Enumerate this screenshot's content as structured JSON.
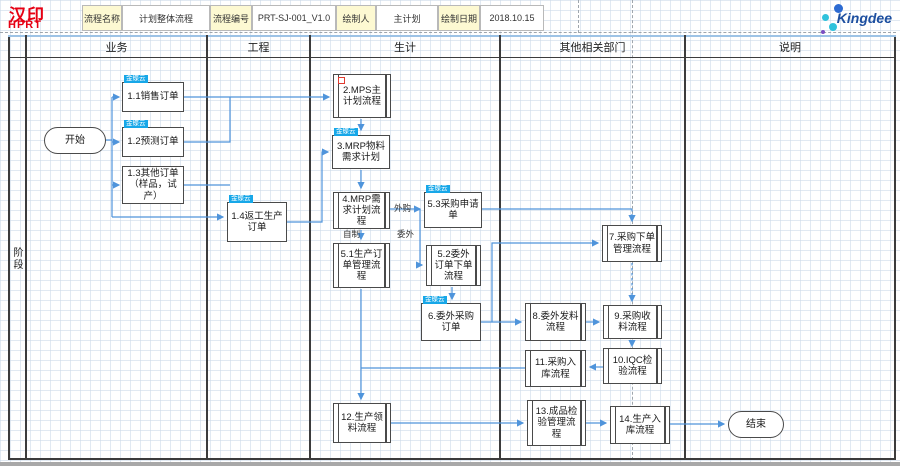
{
  "header": {
    "logo": {
      "line1": "汉印",
      "line2": "HPRT"
    },
    "fields": [
      {
        "label": "流程名称",
        "value": "计划整体流程"
      },
      {
        "label": "流程编号",
        "value": "PRT-SJ-001_V1.0"
      },
      {
        "label": "绘制人",
        "value": "主计划"
      },
      {
        "label": "绘制日期",
        "value": "2018.10.15"
      }
    ],
    "brand": "Kingdee"
  },
  "sidebar": {
    "phase": "阶段"
  },
  "lanes": [
    {
      "label": "业务"
    },
    {
      "label": "工程"
    },
    {
      "label": "生计"
    },
    {
      "label": "其他相关部门"
    },
    {
      "label": "说明"
    }
  ],
  "ui": {
    "badge_label": "金蝶云",
    "accent": "#4f94db",
    "badge_color": "#17a7e8",
    "border_color": "#4a4a4a",
    "logo_red": "#e60013",
    "brand_blue": "#1d4fa0"
  },
  "edges": {
    "outsourced_purchase": "外购",
    "self_made": "自制",
    "outsourced": "委外"
  },
  "nodes": {
    "start": {
      "label": "开始"
    },
    "n1_1": {
      "label": "1.1销售订单"
    },
    "n1_2": {
      "label": "1.2预测订单"
    },
    "n1_3": {
      "label": "1.3其他订单（样品，试产）"
    },
    "n1_4": {
      "label": "1.4返工生产订单"
    },
    "n2": {
      "label": "2.MPS主计划流程"
    },
    "n3": {
      "label": "3.MRP物料需求计划"
    },
    "n4": {
      "label": "4.MRP需求计划流程"
    },
    "n5_1": {
      "label": "5.1生产订单管理流程"
    },
    "n5_2": {
      "label": "5.2委外订单下单流程"
    },
    "n5_3": {
      "label": "5.3采购申请单"
    },
    "n6": {
      "label": "6.委外采购订单"
    },
    "n7": {
      "label": "7.采购下单管理流程"
    },
    "n8": {
      "label": "8.委外发料流程"
    },
    "n9": {
      "label": "9.采购收料流程"
    },
    "n10": {
      "label": "10.IQC检验流程"
    },
    "n11": {
      "label": "11.采购入库流程"
    },
    "n12": {
      "label": "12.生产领料流程"
    },
    "n13": {
      "label": "13.成品检验管理流程"
    },
    "n14": {
      "label": "14.生产入库流程"
    },
    "end": {
      "label": "结束"
    }
  }
}
